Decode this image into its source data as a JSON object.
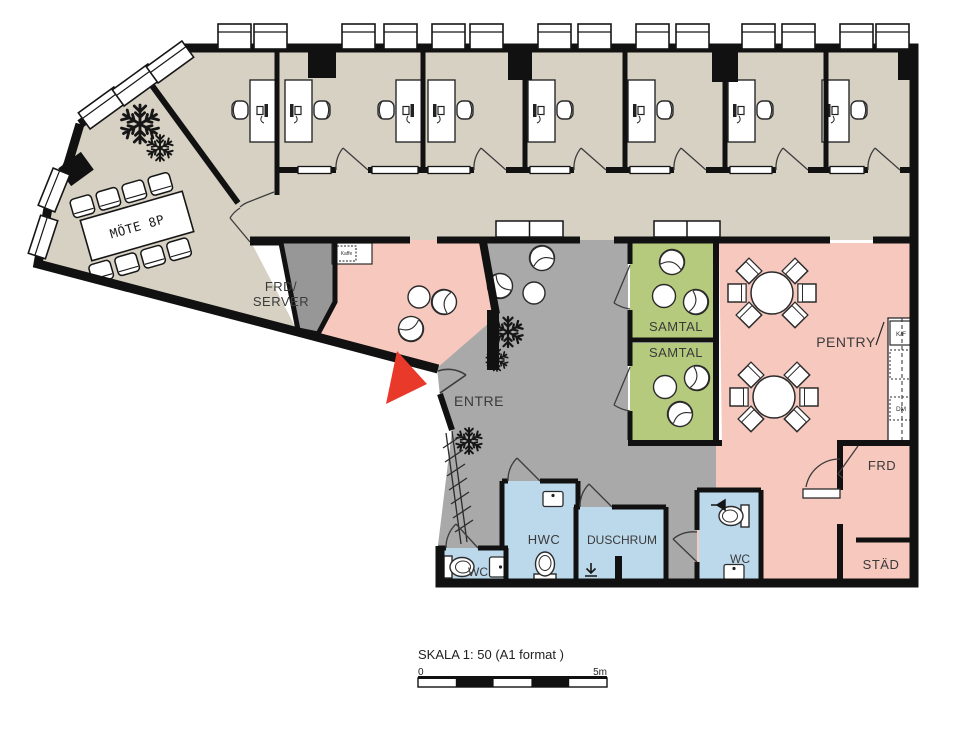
{
  "colors": {
    "office_beige": "#d7d1c4",
    "entre_gray": "#a9a9a9",
    "server_gray": "#979797",
    "pink": "#f7c8bd",
    "green": "#b5ca7d",
    "blue": "#bcd9ec",
    "wall_black": "#111111",
    "arrow_red": "#e8392b"
  },
  "labels": {
    "mote": "MÖTE 8P",
    "frd_server_line1": "FRD/",
    "frd_server_line2": "SERVER",
    "entre": "ENTRE",
    "samtal_1": "SAMTAL",
    "samtal_2": "SAMTAL",
    "pentry": "PENTRY",
    "kf": "K/F",
    "dm": "DM",
    "frd": "FRD",
    "stad": "STÄD",
    "hwc": "HWC",
    "duschrum": "DUSCHRUM",
    "wc_left": "WC",
    "wc_right": "WC",
    "kaffe": "Kaffe"
  },
  "scale_bar": {
    "title": "SKALA 1: 50 (A1 format )",
    "start": "0",
    "end": "5m"
  }
}
